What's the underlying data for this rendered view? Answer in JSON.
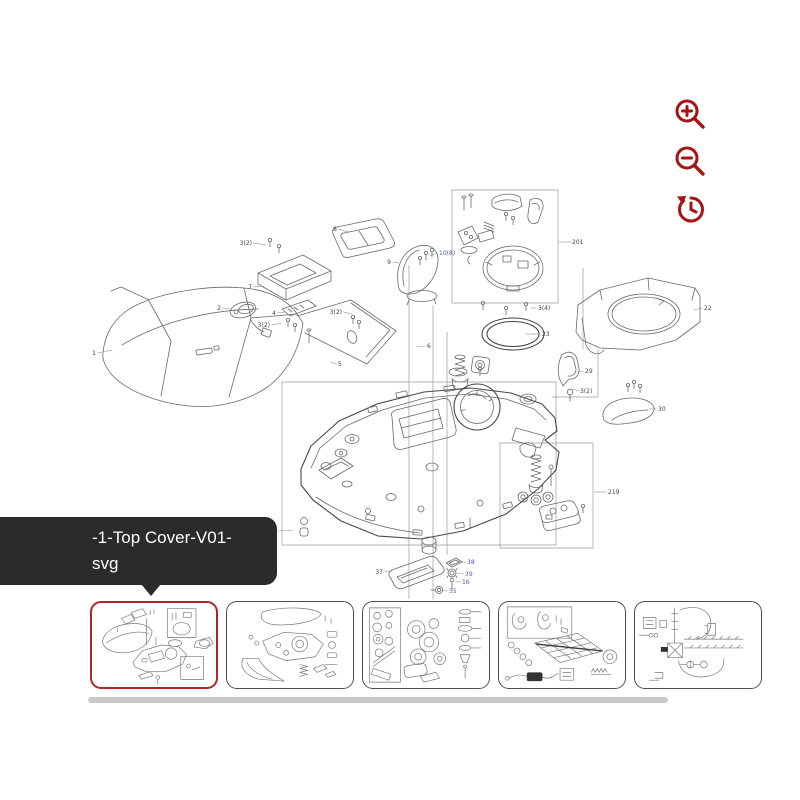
{
  "viewer": {
    "toolbar": {
      "icons": [
        "zoom-in",
        "zoom-out",
        "history-restore"
      ]
    },
    "tooltip": {
      "line1": "-1-Top Cover-V01-",
      "line2": "svg"
    },
    "thumbnails": {
      "count": 5,
      "selected_index": 0
    },
    "colors": {
      "accent_red": "#a81212",
      "selected_thumb_border": "#b12626",
      "thumb_border": "#4f4f4f",
      "tooltip_bg": "#2b2b2b",
      "tooltip_text": "#ffffff",
      "scrollbar": "#c9c9c9",
      "drawing_line": "#6a6a6a",
      "callout_text": "#454545",
      "callout_text_blue": "#4a5fae"
    }
  },
  "diagram": {
    "callouts": [
      {
        "t": "1",
        "x": 96,
        "y": 353,
        "lx": 112,
        "ly": 350
      },
      {
        "t": "2",
        "x": 221,
        "y": 308,
        "lx": 230,
        "ly": 309
      },
      {
        "t": "3(2)",
        "x": 252,
        "y": 243,
        "lx": 266,
        "ly": 245
      },
      {
        "t": "7",
        "x": 252,
        "y": 287,
        "lx": 264,
        "ly": 286
      },
      {
        "t": "4",
        "x": 276,
        "y": 313,
        "lx": 285,
        "ly": 312
      },
      {
        "t": "3(2)",
        "x": 270,
        "y": 325,
        "lx": 282,
        "ly": 323
      },
      {
        "t": "8",
        "x": 337,
        "y": 229,
        "lx": 348,
        "ly": 232
      },
      {
        "t": "9",
        "x": 391,
        "y": 262,
        "lx": 399,
        "ly": 263
      },
      {
        "t": "10(8)",
        "x": 439,
        "y": 253,
        "lx": 430,
        "ly": 256,
        "blue": true
      },
      {
        "t": "3(2)",
        "x": 342,
        "y": 312,
        "lx": 352,
        "ly": 314
      },
      {
        "t": "5",
        "x": 338,
        "y": 364,
        "lx": 330,
        "ly": 362
      },
      {
        "t": "6",
        "x": 427,
        "y": 346,
        "lx": 416,
        "ly": 347
      },
      {
        "t": "201",
        "x": 572,
        "y": 242,
        "lx": 559,
        "ly": 242
      },
      {
        "t": "3(4)",
        "x": 538,
        "y": 308,
        "lx": 531,
        "ly": 308
      },
      {
        "t": "23",
        "x": 542,
        "y": 334,
        "lx": 526,
        "ly": 334
      },
      {
        "t": "22",
        "x": 704,
        "y": 308,
        "lx": 694,
        "ly": 310
      },
      {
        "t": "29",
        "x": 585,
        "y": 371,
        "lx": 577,
        "ly": 372
      },
      {
        "t": "3(2)",
        "x": 580,
        "y": 391,
        "lx": 573,
        "ly": 389
      },
      {
        "t": "30",
        "x": 658,
        "y": 409,
        "lx": 649,
        "ly": 409
      },
      {
        "t": "219",
        "x": 608,
        "y": 492,
        "lx": 594,
        "ly": 492
      },
      {
        "t": "229",
        "x": 276,
        "y": 531,
        "lx": 293,
        "ly": 530
      },
      {
        "t": "37",
        "x": 383,
        "y": 572,
        "lx": 392,
        "ly": 571
      },
      {
        "t": "38",
        "x": 467,
        "y": 562,
        "lx": 459,
        "ly": 562,
        "blue": true
      },
      {
        "t": "39",
        "x": 465,
        "y": 574,
        "lx": 457,
        "ly": 573,
        "blue": true
      },
      {
        "t": "16",
        "x": 462,
        "y": 582,
        "lx": 455,
        "ly": 581,
        "blue": true
      },
      {
        "t": "35",
        "x": 449,
        "y": 591,
        "lx": 442,
        "ly": 590,
        "blue": true
      }
    ]
  }
}
